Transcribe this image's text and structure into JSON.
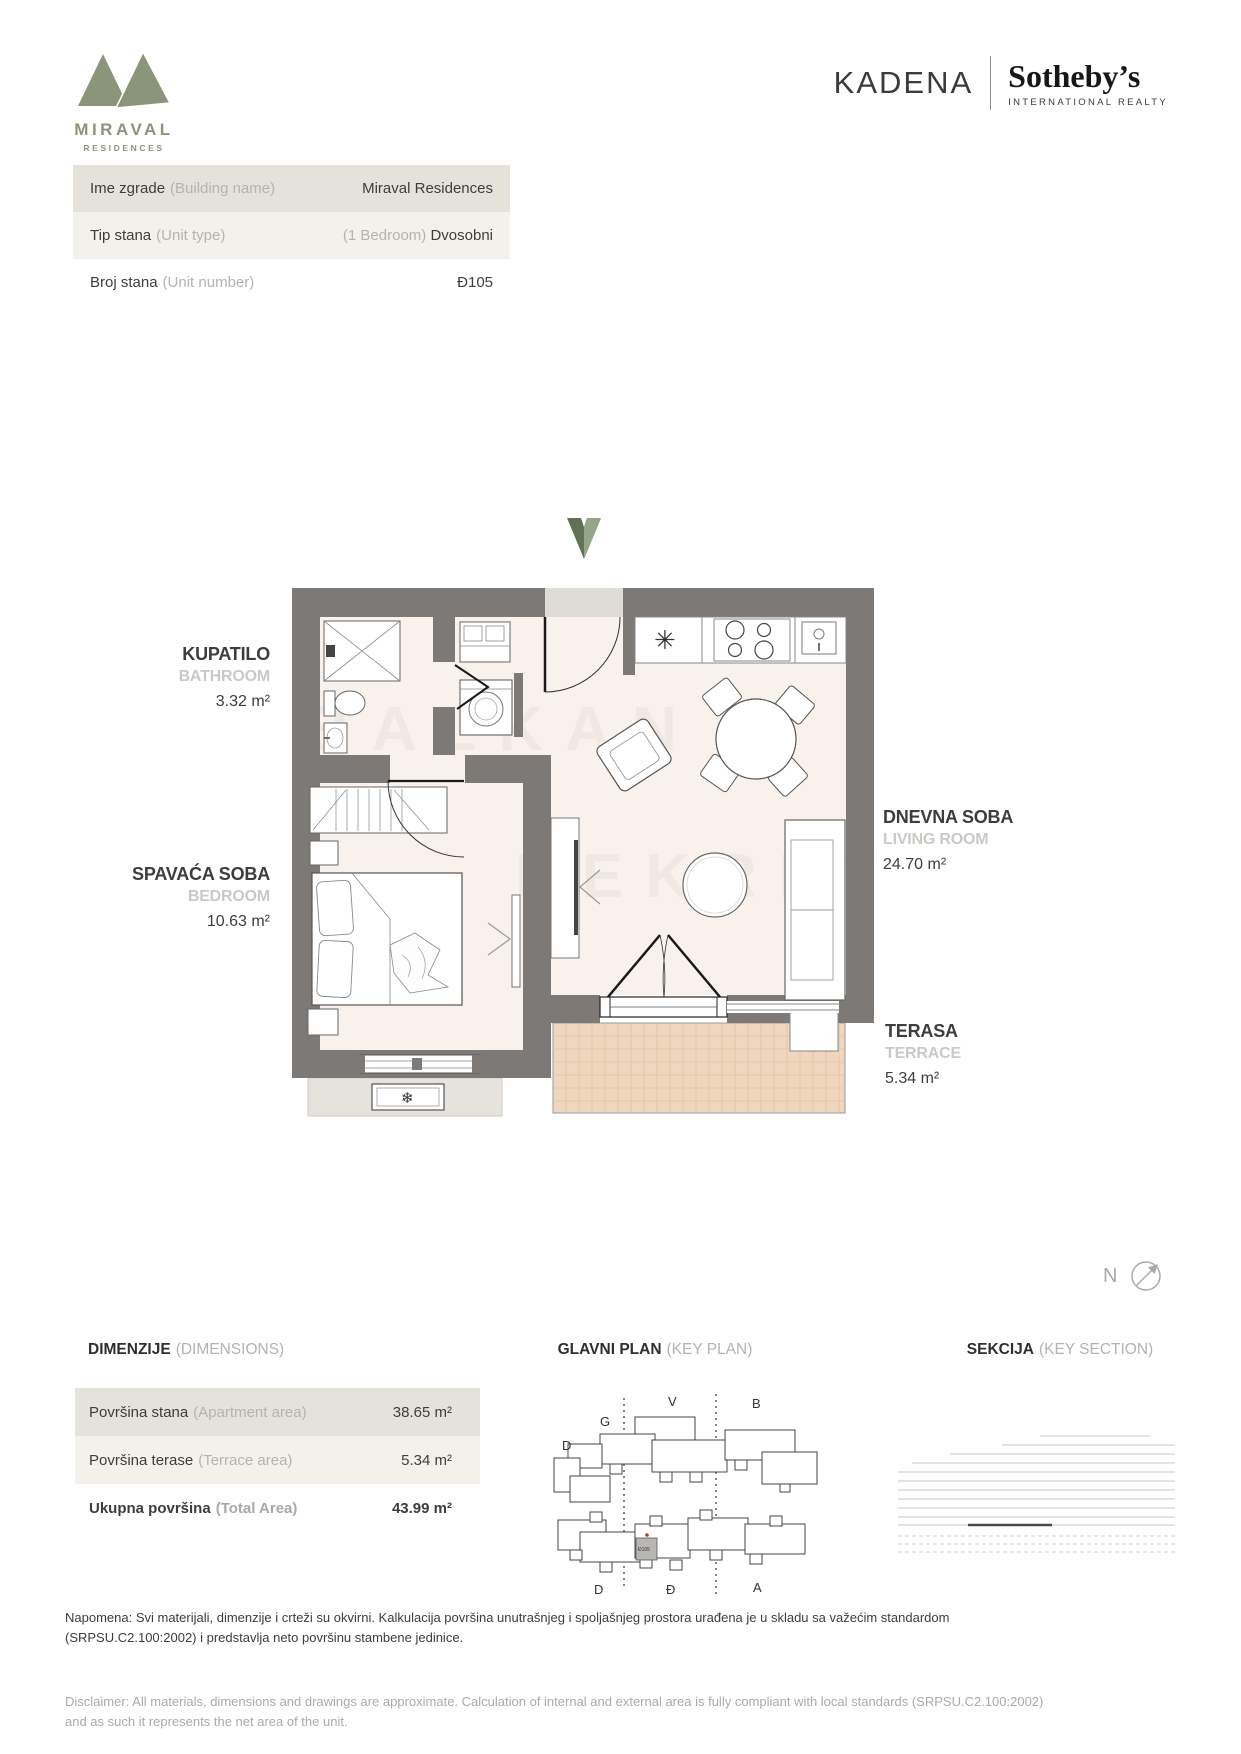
{
  "brand": {
    "miraval": "MIRAVAL",
    "miraval_sub": "RESIDENCES",
    "kadena": "KADENA",
    "sothebys": "Sotheby’s",
    "sothebys_sub": "INTERNATIONAL REALTY"
  },
  "unit_info": {
    "rows": [
      {
        "label_sr": "Ime zgrade",
        "label_en": "(Building name)",
        "value_prefix": "",
        "value": "Miraval Residences"
      },
      {
        "label_sr": "Tip stana",
        "label_en": "(Unit type)",
        "value_prefix": "(1 Bedroom) ",
        "value": "Dvosobni"
      },
      {
        "label_sr": "Broj stana",
        "label_en": "(Unit number)",
        "value_prefix": "",
        "value": "Đ105"
      }
    ]
  },
  "floor_plan": {
    "rooms": [
      {
        "name": "KUPATILO",
        "name_en": "BATHROOM",
        "area": "3.32 m²"
      },
      {
        "name": "SPAVAĆA SOBA",
        "name_en": "BEDROOM",
        "area": "10.63 m²"
      },
      {
        "name": "DNEVNA SOBA",
        "name_en": "LIVING ROOM",
        "area": "24.70 m²"
      },
      {
        "name": "TERASA",
        "name_en": "TERRACE",
        "area": "5.34 m²"
      }
    ],
    "north_label": "N",
    "ac_unit_icon": "❄",
    "kitchen_sink_icon": "✳",
    "watermark_line1": "BALKAN",
    "watermark_line2": "NEKRET"
  },
  "dimensions": {
    "title": "DIMENZIJE",
    "title_en": "(DIMENSIONS)",
    "rows": [
      {
        "label_sr": "Površina stana",
        "label_en": "(Apartment area)",
        "value": "38.65 m²"
      },
      {
        "label_sr": "Površina terase",
        "label_en": "(Terrace area)",
        "value": "5.34 m²"
      },
      {
        "label_sr": "Ukupna površina",
        "label_en": "(Total Area)",
        "value": "43.99 m²"
      }
    ]
  },
  "key_plan": {
    "title": "GLAVNI PLAN",
    "title_en": "(KEY PLAN)",
    "labels_top": [
      "V",
      "B",
      "G",
      "D"
    ],
    "labels_bottom": [
      "D",
      "Đ",
      "A"
    ],
    "highlighted_unit": "Đ105"
  },
  "key_section": {
    "title": "SEKCIJA",
    "title_en": "(KEY SECTION)"
  },
  "notes": {
    "sr": "Napomena: Svi materijali, dimenzije i crteži su okvirni. Kalkulacija površina unutrašnjeg i spoljašnjeg prostora urađena je u skladu sa važećim standardom (SRPSU.C2.100:2002) i predstavlja neto površinu stambene jedinice.",
    "en": "Disclaimer: All materials, dimensions and drawings are approximate. Calculation of internal and external area is fully compliant with local standards (SRPSU.C2.100:2002) and as such it represents the net area of the unit."
  },
  "colors": {
    "brand_green": "#8B9579",
    "arrow_green_dark": "#5F7258",
    "arrow_green_light": "#94A58A",
    "wall_gray": "#7C7976",
    "floor": "#F8F1EC",
    "terrace": "#EFD6BC",
    "row_bg_dark": "#E4E2D9",
    "row_bg_light": "#F2F1EC"
  }
}
